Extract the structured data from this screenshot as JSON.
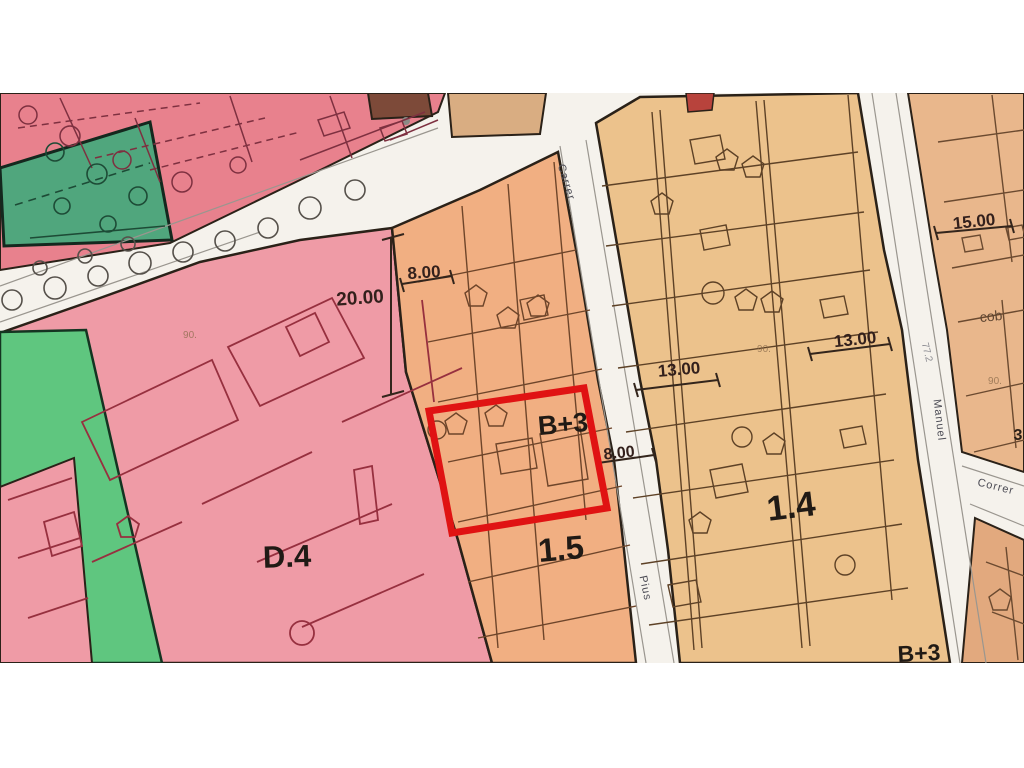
{
  "page": {
    "type": "urban-zoning-plan"
  },
  "colors": {
    "page_bg": "#ffffff",
    "street": "#f5f2ec",
    "zone_pink_top": "#e8818d",
    "zone_teal": "#50a67d",
    "zone_green": "#5fc67f",
    "zone_d4": "#ef9ba6",
    "zone_orange15": "#f1af82",
    "zone_tan14": "#ecc28c",
    "zone_right_top": "#e9b78c",
    "zone_right_bottom": "#e2a97e",
    "block_brown": "#7d4a39",
    "block_tan": "#d9ad82",
    "block_red": "#b8433c",
    "highlight_red": "#e01313",
    "line_dark": "#2a2118",
    "line_maroon": "#97303f"
  },
  "zone_labels": {
    "d4": {
      "text": "D.4"
    },
    "sector15": {
      "text": "1.5"
    },
    "sector14": {
      "text": "1.4"
    },
    "b3_highlight": {
      "text": "B+3"
    },
    "b3_corner": {
      "text": "B+3"
    }
  },
  "dimensions": {
    "top_8": {
      "text": "8.00"
    },
    "top_20": {
      "text": "20.00"
    },
    "mid_8": {
      "text": "8.00"
    },
    "left_13": {
      "text": "13.00"
    },
    "right_13": {
      "text": "13.00"
    },
    "right_15": {
      "text": "15.00"
    }
  },
  "streets": {
    "carrer": {
      "name": "Carrer"
    },
    "pius": {
      "name": "Pius"
    },
    "manuel": {
      "name": "Manuel"
    },
    "correr": {
      "name": "Correr"
    }
  },
  "annotations": {
    "cob": {
      "text": "cob"
    },
    "p90a": {
      "text": "90."
    },
    "p90b": {
      "text": "90."
    },
    "p90c": {
      "text": "90."
    },
    "p772": {
      "text": "77.2"
    },
    "p3": {
      "text": "3"
    }
  }
}
